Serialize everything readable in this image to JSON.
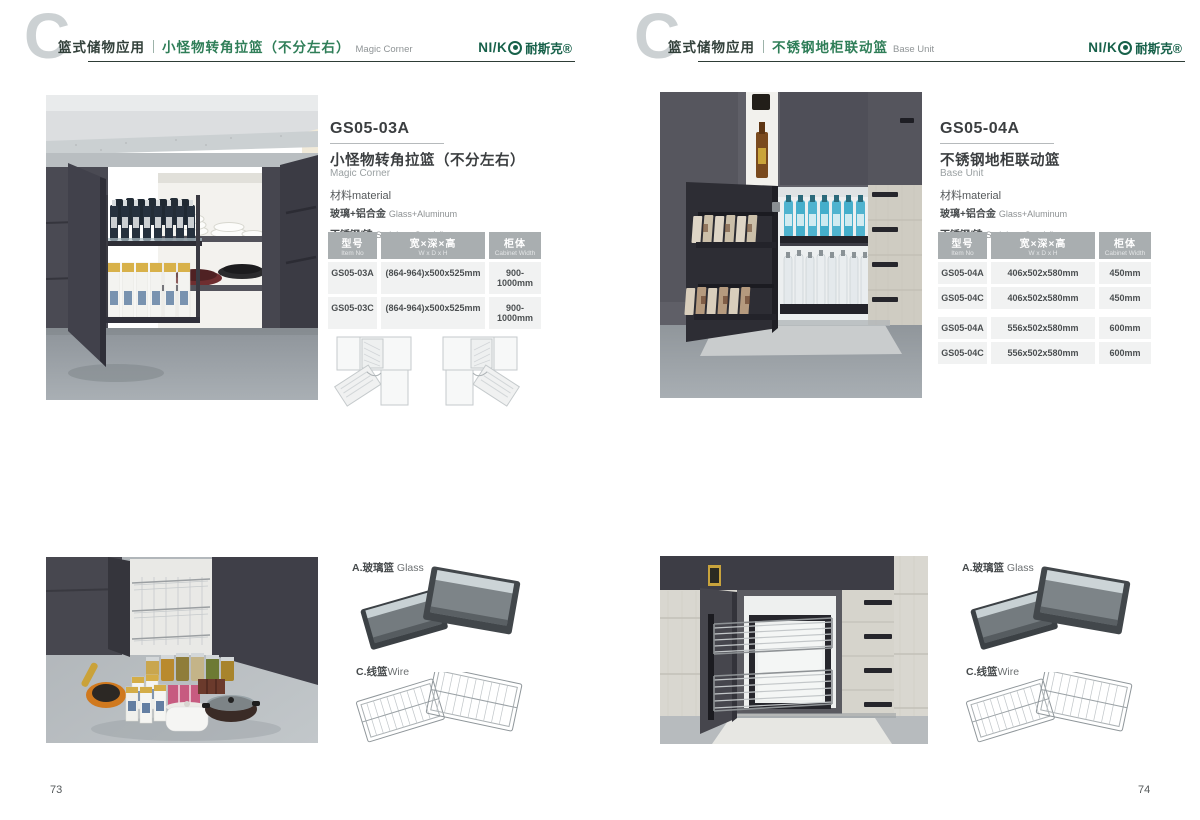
{
  "brand": {
    "prefix": "NI/K",
    "cn": "耐斯克®"
  },
  "colors": {
    "brand_green": "#17614a",
    "section_green": "#2f7e58",
    "table_header_bg": "#a9aeb0",
    "table_cell_bg": "#f1f2f2"
  },
  "left": {
    "header": {
      "category": "篮式储物应用",
      "title_cn": "小怪物转角拉篮（不分左右）",
      "title_en": "Magic Corner"
    },
    "product": {
      "code": "GS05-03A",
      "name_cn": "小怪物转角拉篮（不分左右）",
      "name_en": "Magic Corner",
      "material_label": "材料material",
      "materials": [
        {
          "cn": "玻璃+铝合金",
          "en": "Glass+Aluminum"
        },
        {
          "cn": "不锈钢/铁",
          "en": "Stainless SteeL/Iron"
        }
      ]
    },
    "table": {
      "headers": [
        {
          "cn": "型号",
          "en": "Item No"
        },
        {
          "cn": "宽×深×高",
          "en": "W x D x H"
        },
        {
          "cn": "柜体",
          "en": "Cabinet Width"
        }
      ],
      "rows": [
        [
          "GS05-03A",
          "(864-964)x500x525mm",
          "900-1000mm"
        ],
        [
          "GS05-03C",
          "(864-964)x500x525mm",
          "900-1000mm"
        ]
      ]
    },
    "accessories": [
      {
        "label_cn": "A.玻璃篮",
        "label_en": "Glass"
      },
      {
        "label_cn": "C.线篮",
        "label_en": "Wire"
      }
    ],
    "page_number": "73"
  },
  "right": {
    "header": {
      "category": "篮式储物应用",
      "title_cn": "不锈钢地柜联动篮",
      "title_en": "Base Unit"
    },
    "product": {
      "code": "GS05-04A",
      "name_cn": "不锈钢地柜联动篮",
      "name_en": "Base Unit",
      "material_label": "材料material",
      "materials": [
        {
          "cn": "玻璃+铝合金",
          "en": "Glass+Aluminum"
        },
        {
          "cn": "不锈钢/铁",
          "en": "Stainless SteeL/Iron"
        }
      ]
    },
    "table": {
      "headers": [
        {
          "cn": "型号",
          "en": "Item No"
        },
        {
          "cn": "宽×深×高",
          "en": "W x D x H"
        },
        {
          "cn": "柜体",
          "en": "Cabinet Width"
        }
      ],
      "rows": [
        [
          "GS05-04A",
          "406x502x580mm",
          "450mm"
        ],
        [
          "GS05-04C",
          "406x502x580mm",
          "450mm"
        ],
        [
          "GS05-04A",
          "556x502x580mm",
          "600mm"
        ],
        [
          "GS05-04C",
          "556x502x580mm",
          "600mm"
        ]
      ]
    },
    "accessories": [
      {
        "label_cn": "A.玻璃篮",
        "label_en": "Glass"
      },
      {
        "label_cn": "C.线篮",
        "label_en": "Wire"
      }
    ],
    "page_number": "74"
  }
}
